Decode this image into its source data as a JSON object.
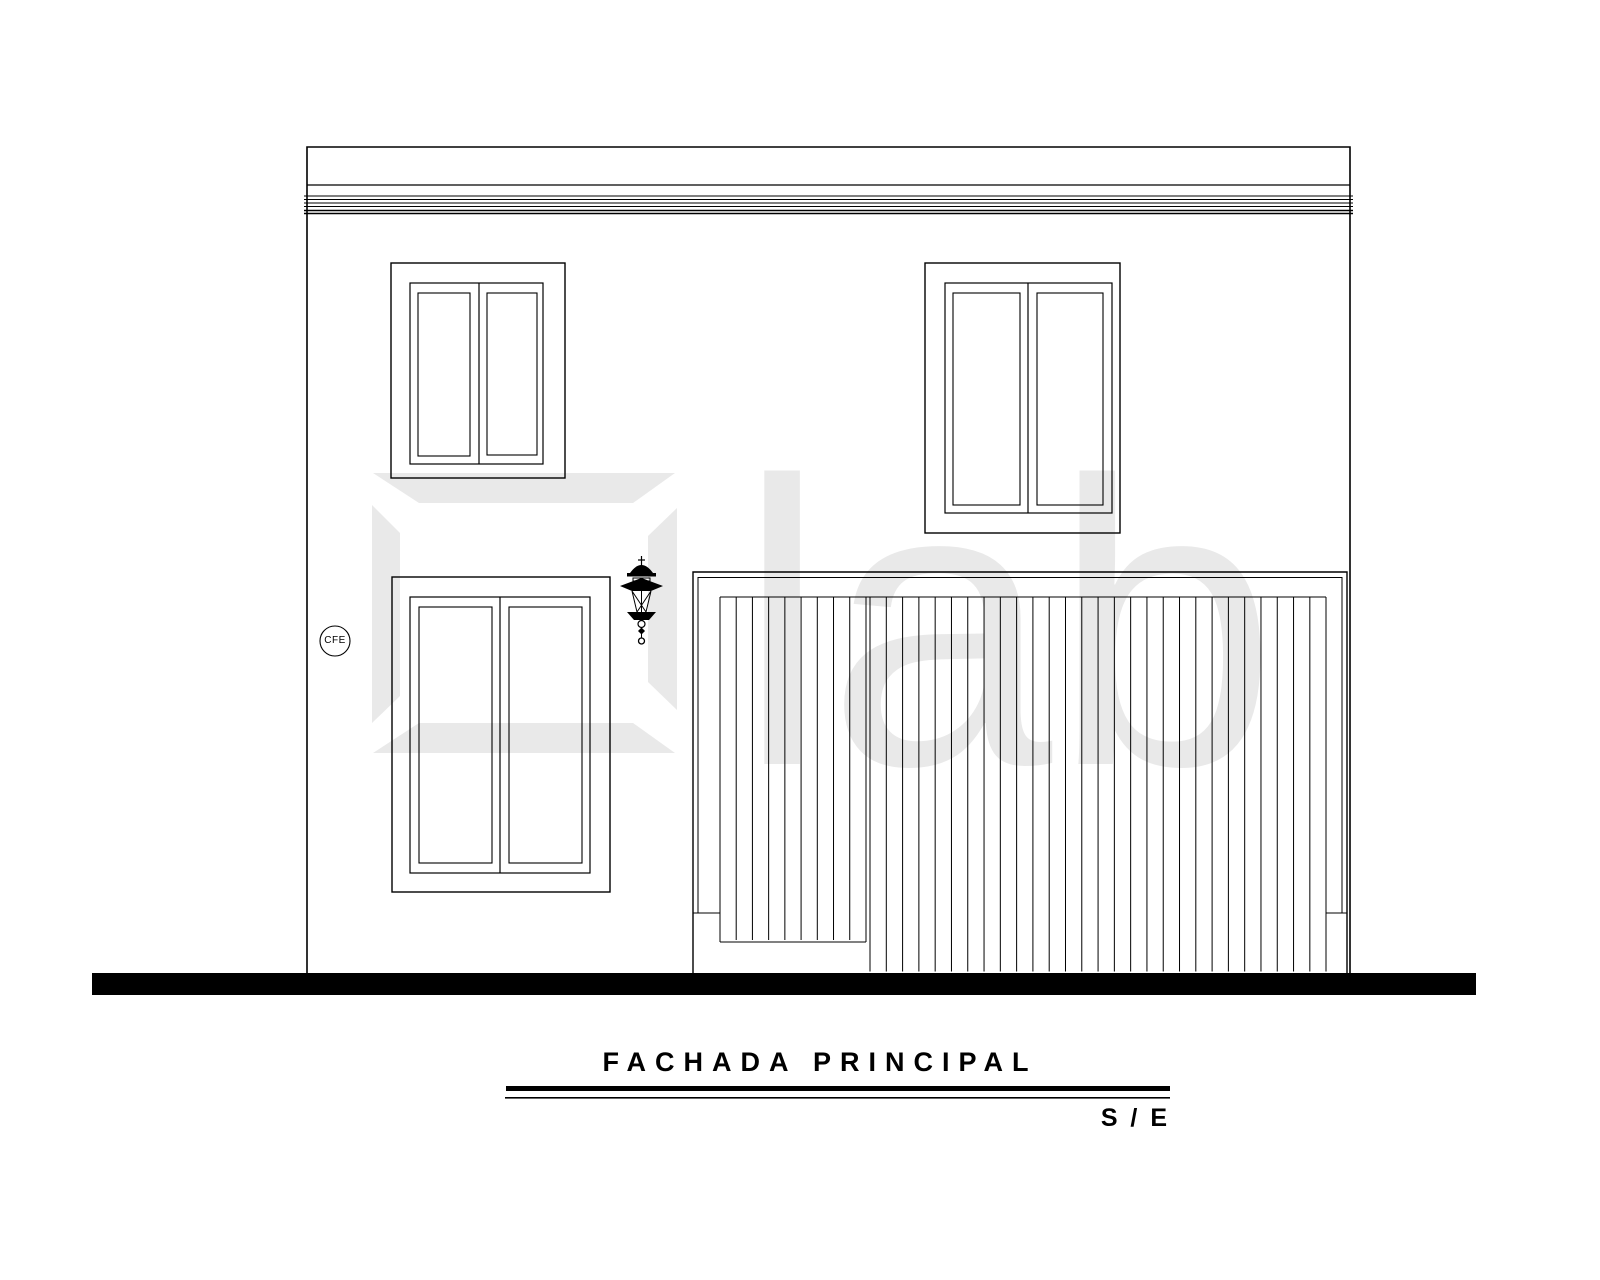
{
  "sheet": {
    "kind": "architectural elevation drawing"
  },
  "colors": {
    "ink": "#000000",
    "watermark": "#e9e9e9",
    "paper": "#ffffff",
    "ground_band": "#000000"
  },
  "watermark": {
    "text": "lab",
    "logo": "elab-square-logo"
  },
  "facade": {
    "meter_label": "CFE"
  },
  "title_block": {
    "title": "FACHADA PRINCIPAL",
    "scale": "S / E"
  }
}
